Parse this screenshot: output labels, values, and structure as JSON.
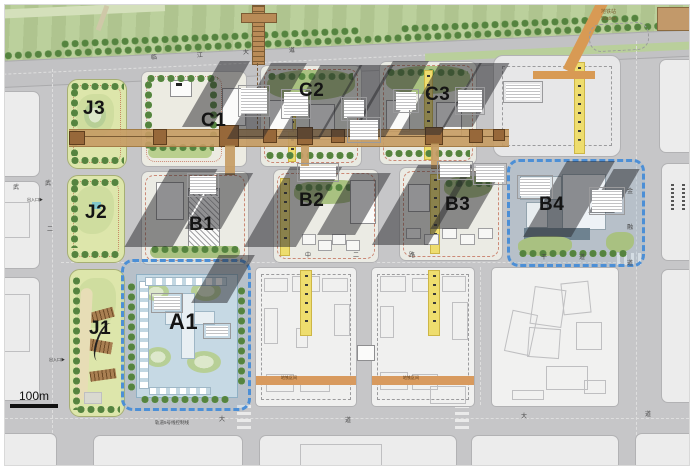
{
  "plan": {
    "parcels": {
      "J1": "J1",
      "J2": "J2",
      "J3": "J3",
      "A1": "A1",
      "B1": "B1",
      "B2": "B2",
      "B3": "B3",
      "B4": "B4",
      "C1": "C1",
      "C2": "C2",
      "C3": "C3"
    },
    "scale_label": "100m",
    "roads": {
      "top": [
        "临",
        "江",
        "大",
        "道"
      ],
      "bottom": [
        "大",
        "道",
        "大",
        "道"
      ],
      "middle": [
        "中",
        "二",
        "路"
      ],
      "middle_east": [
        "干",
        "道"
      ],
      "left": [
        "武",
        "二"
      ],
      "west": "武",
      "right": [
        "金",
        "融",
        "道"
      ]
    },
    "notes": {
      "station_line1": "地铁站",
      "station_line2": "Station",
      "rail_note": "轨道5号线控制线",
      "metro_section_1": "地铁区间",
      "metro_section_2": "地铁区间",
      "entry_j1": "出入口▶",
      "entry_j2": "出入口▶"
    },
    "colors": {
      "zone_blue": "#4c8fd6",
      "park_green": "#dde6ab",
      "road_gray": "#c6c6c8",
      "spine_tan": "#c89e66",
      "greenway_yellow": "#eedd6e",
      "metro_orange": "#d89a54"
    }
  }
}
